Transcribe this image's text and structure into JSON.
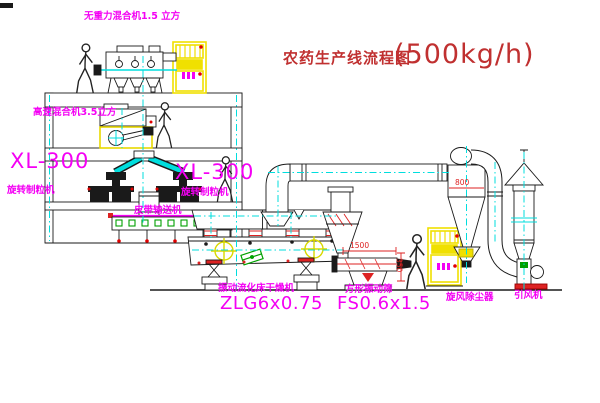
{
  "title": {
    "main": "农药生产线流程图",
    "capacity": "(500kg/h)"
  },
  "labels": {
    "gravity_free_mixer": "无重力混合机1.5 立方",
    "high_speed_mixer": "高速混合机3.5立方",
    "granulator_left_model": "XL-300",
    "granulator_left_name": "旋转制粒机",
    "granulator_right_model": "XL-300",
    "granulator_right_name": "旋转制粒机",
    "belt_conveyor": "皮带输送机",
    "dryer_name": "振动流化床干燥机",
    "dryer_model": "ZLG6x0.75",
    "screen_name": "方形振动筛",
    "screen_model": "FS0.6x1.5",
    "cyclone": "旋风除尘器",
    "induced_draft_fan": "引风机"
  },
  "dimensions": {
    "screen_length": "1500",
    "cyclone_body": "800",
    "screen_outlet": "350"
  },
  "colors": {
    "label_magenta": "#f400f4",
    "title_red": "#c03030",
    "dimension_red": "#dd2222",
    "centerline_cyan": "#00dede",
    "cabinet_yellow": "#f0e000",
    "detail_green": "#00a000",
    "line_black": "#1a1a1a",
    "background": "#ffffff"
  }
}
